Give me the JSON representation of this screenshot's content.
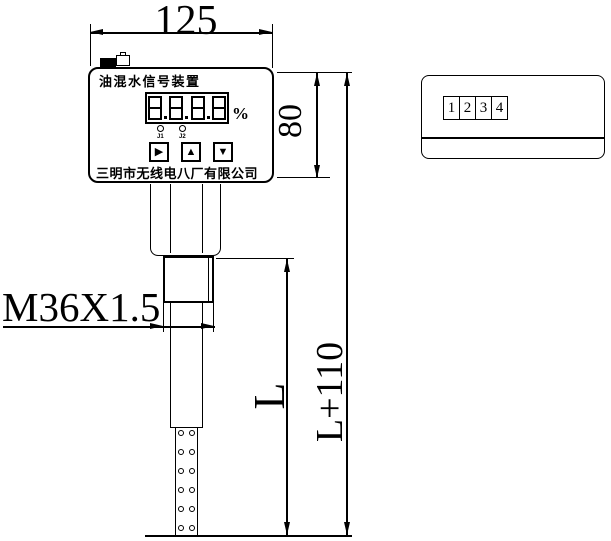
{
  "dims": {
    "width": "125",
    "height": "80",
    "total_length": "L+110",
    "insert_length": "L",
    "thread": "M36X1.5"
  },
  "device": {
    "title": "油混水信号装置",
    "display": {
      "value": "8.8.8.8",
      "unit": "%"
    },
    "leds": [
      {
        "label": "J1"
      },
      {
        "label": "J2"
      }
    ],
    "buttons": [
      {
        "name": "right",
        "glyph": "▶"
      },
      {
        "name": "up",
        "glyph": "▲"
      },
      {
        "name": "down",
        "glyph": "▼"
      }
    ],
    "company": "三明市无线电八厂有限公司"
  },
  "terminal_box": {
    "terminals": [
      "1",
      "2",
      "3",
      "4"
    ]
  },
  "colors": {
    "line": "#000000",
    "background": "#ffffff"
  }
}
